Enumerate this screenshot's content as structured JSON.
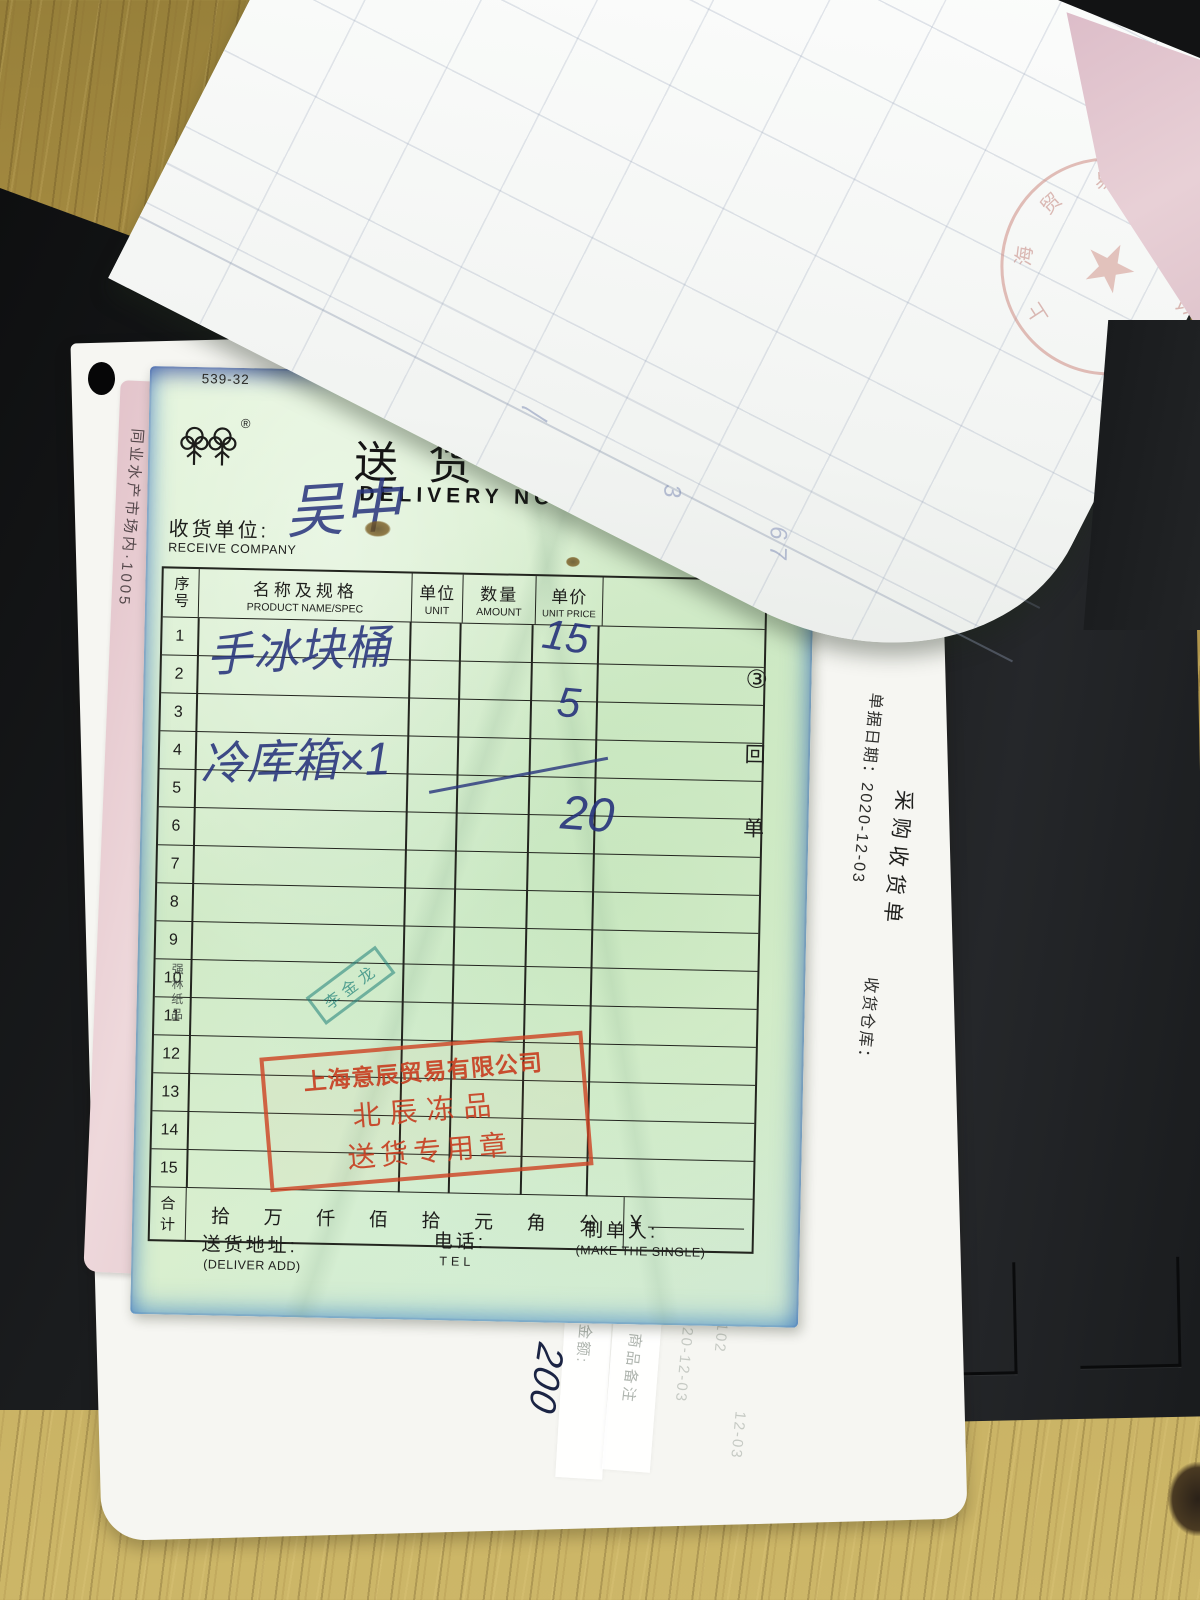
{
  "green_form": {
    "form_code": "539-32",
    "brand_registered": "®",
    "title_cn": "送货单",
    "title_en": "DELIVERY NOTE",
    "receiver_label_cn": "收货单位:",
    "receiver_label_en": "RECEIVE COMPANY",
    "receiver_handwriting": "吴中",
    "side_label": "强林纸品",
    "copy_circle": "③",
    "copy_char_1": "回",
    "copy_char_2": "单",
    "table": {
      "headers": {
        "no_cn": "序号",
        "name_cn": "名称及规格",
        "name_en": "PRODUCT NAME/SPEC",
        "unit_cn": "单位",
        "unit_en": "UNIT",
        "qty_cn": "数量",
        "qty_en": "AMOUNT",
        "price_cn": "单价",
        "price_en": "UNIT PRICE"
      },
      "row_numbers": [
        "1",
        "2",
        "3",
        "4",
        "5",
        "6",
        "7",
        "8",
        "9",
        "10",
        "11",
        "12",
        "13",
        "14",
        "15"
      ],
      "handwriting": {
        "item1": "手冰块桶",
        "item2": "冷库箱×1",
        "price1": "15",
        "price2": "5",
        "price3": "20"
      }
    },
    "total": {
      "label_char_1": "合",
      "label_char_2": "计",
      "units": [
        "拾",
        "万",
        "仟",
        "佰",
        "拾",
        "元",
        "角",
        "分"
      ],
      "currency": "¥"
    },
    "footer": {
      "address_cn": "送货地址:",
      "address_en": "(DELIVER ADD)",
      "tel_cn": "电话:",
      "tel_en": "TEL",
      "maker_cn": "制单人:",
      "maker_en": "(MAKE THE SINGLE)"
    },
    "red_stamp": {
      "line1": "上海意辰贸易有限公司",
      "line2": "北辰冻品",
      "line3": "送货专用章"
    },
    "name_chop": "李金龙"
  },
  "purchase_sheet": {
    "title": "采购收货单",
    "date_line": "单据日期：2020-12-03",
    "warehouse_label": "收货仓库：",
    "amount_label": "金额:",
    "amount_handwriting": "200",
    "remark_label": "商品备注",
    "doc_number": "476102",
    "doc_date_fragment": "12-03",
    "faint_date": "2020-12-03"
  },
  "pink_sheet": {
    "edge_text": "同业水产市场内·1005"
  },
  "top_sheet": {
    "pencil_mark_1": "3",
    "pencil_mark_2": "6 7",
    "pencil_mark_3": "〳",
    "seal_star": "★",
    "seal_chars": [
      "上",
      "海",
      "贸",
      "易",
      "有",
      "限",
      "公",
      "司"
    ]
  }
}
